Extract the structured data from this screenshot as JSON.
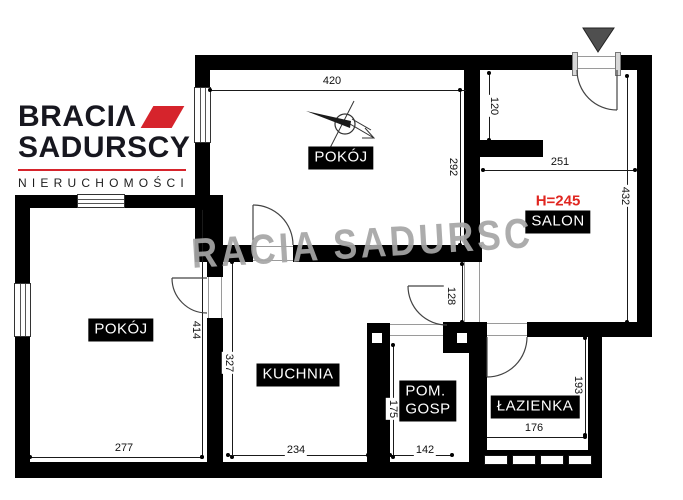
{
  "logo": {
    "brand_line1": "BRACIΛ",
    "brand_line2": "SADURSCY",
    "tagline": "NIERUCHOMOŚCI"
  },
  "watermark": {
    "text": "RACIA SADURSC"
  },
  "rooms": {
    "room_top": {
      "label": "POKÓJ"
    },
    "room_left": {
      "label": "POKÓJ"
    },
    "salon": {
      "label": "SALON",
      "ceiling_height": "H=245"
    },
    "kitchen": {
      "label": "KUCHNIA"
    },
    "utility": {
      "label_line1": "POM.",
      "label_line2": "GOSP"
    },
    "bathroom": {
      "label": "ŁAZIENKA"
    }
  },
  "dims": {
    "room_top_width": "420",
    "room_top_height": "292",
    "entry_depth": "120",
    "salon_width": "251",
    "salon_height": "432",
    "hall_passage": "128",
    "room_left_height": "414",
    "kitchen_height": "327",
    "room_left_width": "277",
    "kitchen_width": "234",
    "utility_width": "142",
    "utility_height": "175",
    "bathroom_width": "176",
    "bathroom_height": "193"
  },
  "colors": {
    "wall": "#000000",
    "logo_text": "#17171f",
    "logo_accent": "#d6242c",
    "ceiling_note_red": "#e02620",
    "watermark_gray": "#a6a6a6",
    "entrance_marker_gray": "#4f4f4f"
  }
}
